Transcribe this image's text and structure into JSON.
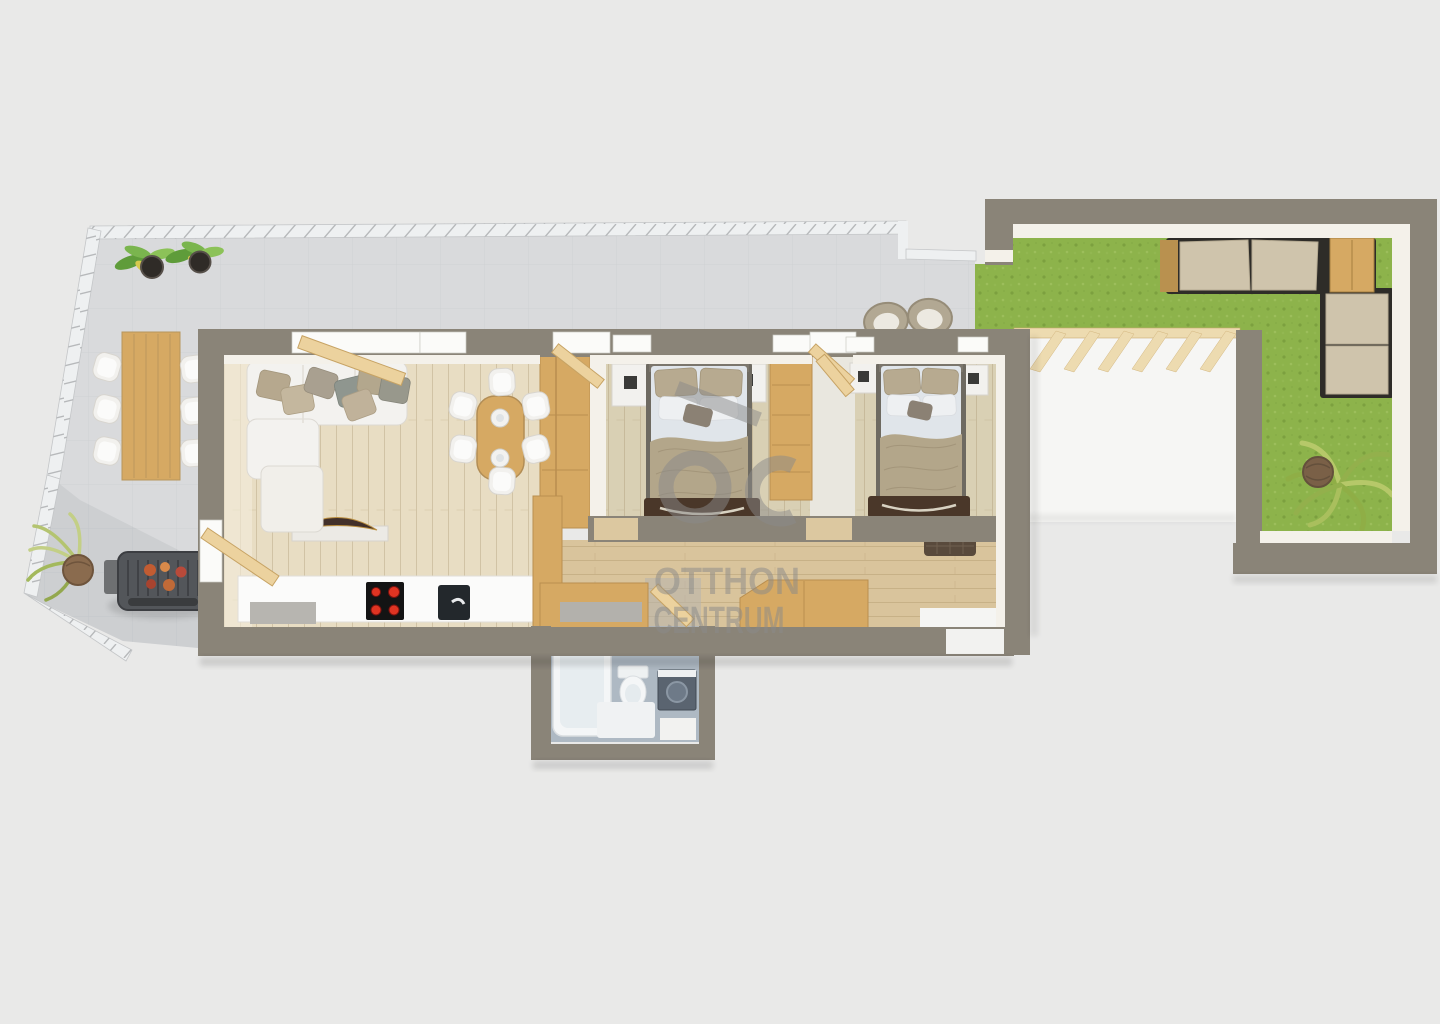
{
  "title": "apartment-3d-floor-plan",
  "background": "#e9e9e8",
  "watermark": {
    "logo_glyphs": "ōc",
    "brand_line1": "OTTHON",
    "brand_line2": "CENTRUM",
    "color": "#8a8a8a"
  },
  "palette": {
    "wall": "#8a8478",
    "wall_face": "#f4f1ea",
    "tile": "#d9dadc",
    "rail": "#eef0f1",
    "grass": "#8db34b",
    "walkway": "#f6f6f4",
    "floor_living": "#e8ddc3",
    "floor_bedroom": "#d9d0b4",
    "floor_hall": "#d9c49c",
    "floor_bath": "#aeb9c3",
    "counter": "#fbfbfa",
    "wood": "#d6a963",
    "pergola": "#eddbb0",
    "sofa": "#f3f2ef",
    "duvet": "#e0e5ea",
    "blanket": "#b3a68a",
    "outdoor_cushion": "#cfc4ac",
    "outdoor_wood": "#b9914f",
    "bench": "#4a3729",
    "grill": "#53565a",
    "burner": "#e03422",
    "bath_white": "#f4f6f7",
    "washer": "#5a6470",
    "tufted_mat": "#594a3c",
    "door_wood": "#ecd29e",
    "window_white": "#fbfbf9"
  },
  "scene": {
    "type": "3d-floor-plan-top-view",
    "rooms": [
      "balcony terrace",
      "living room",
      "dining area",
      "kitchen",
      "hallway",
      "bedroom 1",
      "bedroom 2",
      "bathroom",
      "entry",
      "pergola walkway",
      "garden terrace"
    ]
  },
  "furniture": {
    "balcony": [
      "long wooden table",
      "six white chairs",
      "two potted plants",
      "barbecue grill",
      "floor plant",
      "two wicker lounge chairs"
    ],
    "living_room": [
      "white corner sofa",
      "seven cushions",
      "ottoman",
      "shelf with decorative bowl"
    ],
    "dining": [
      "oval wooden table",
      "six white chairs",
      "two place settings"
    ],
    "kitchen": [
      "white counter",
      "cooktop with four burners",
      "sink",
      "tall cabinet",
      "wardrobe column"
    ],
    "bedroom_1": [
      "double bed",
      "two nightstands",
      "wardrobe",
      "foot bench"
    ],
    "bedroom_2": [
      "double bed",
      "two nightstands",
      "foot bench",
      "tufted ottoman"
    ],
    "bathroom": [
      "bathtub",
      "washbasin",
      "toilet",
      "washing machine",
      "bath mat"
    ],
    "hallway": [
      "wooden sideboard",
      "angled wooden sideboard"
    ],
    "garden": [
      "outdoor corner sofa",
      "wooden side cabinets",
      "pergola beams",
      "palm plant",
      "lawn"
    ]
  }
}
